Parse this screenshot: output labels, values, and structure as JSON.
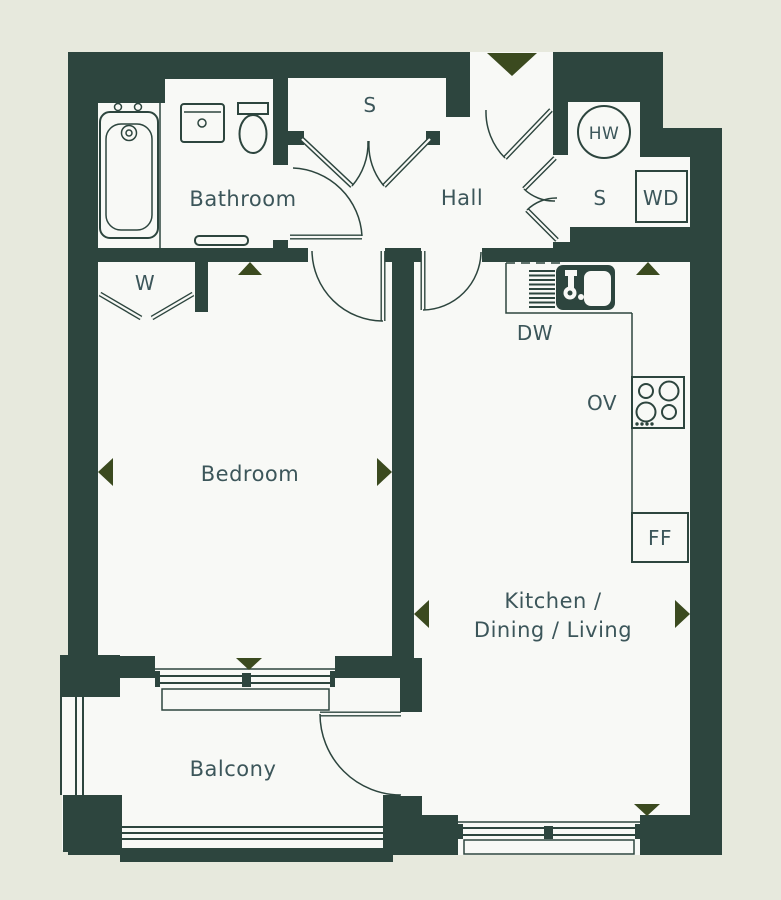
{
  "floorplan": {
    "rooms": {
      "bathroom": {
        "label": "Bathroom"
      },
      "hall": {
        "label": "Hall"
      },
      "bedroom": {
        "label": "Bedroom"
      },
      "kitchen": {
        "label_line1": "Kitchen /",
        "label_line2": "Dining / Living"
      },
      "balcony": {
        "label": "Balcony"
      }
    },
    "closets": {
      "hall_store": {
        "label": "S"
      },
      "utility_store": {
        "label": "S"
      },
      "wardrobe": {
        "label": "W"
      }
    },
    "appliances": {
      "hot_water": {
        "label": "HW"
      },
      "washer_dryer": {
        "label": "WD"
      },
      "dishwasher": {
        "label": "DW"
      },
      "oven": {
        "label": "OV"
      },
      "fridge_freezer": {
        "label": "FF"
      }
    },
    "colors": {
      "wall": "#2d453e",
      "background": "#e7e9dd",
      "interior": "#f8f9f6",
      "marker": "#3b4a1f",
      "label_text": "#3c565a"
    }
  }
}
